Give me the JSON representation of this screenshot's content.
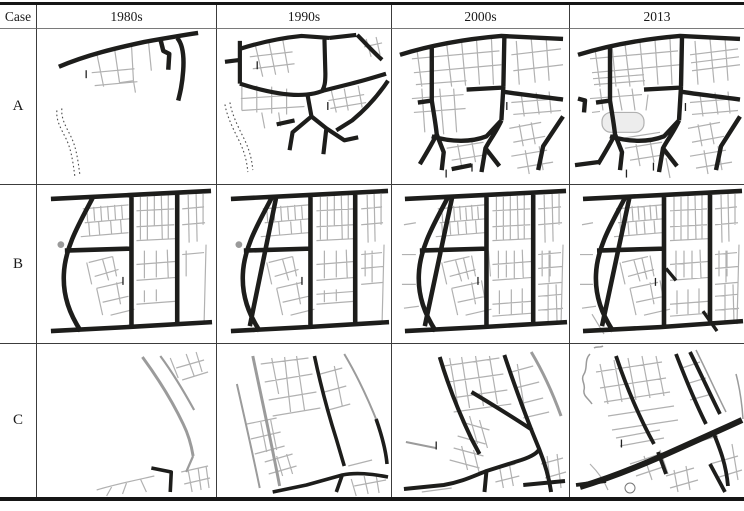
{
  "figure": {
    "header": {
      "case_label": "Case",
      "periods": [
        "1980s",
        "1990s",
        "2000s",
        "2013"
      ]
    },
    "cases": [
      {
        "label": "A"
      },
      {
        "label": "B"
      },
      {
        "label": "C"
      }
    ],
    "palette": {
      "arterial_road": "#1d1d1b",
      "minor_street": "#b1b1b1",
      "gray_road": "#9b9b9b",
      "stream": "#4c4c4c",
      "table_line": "#3c3c3c",
      "background": "#ffffff"
    }
  }
}
